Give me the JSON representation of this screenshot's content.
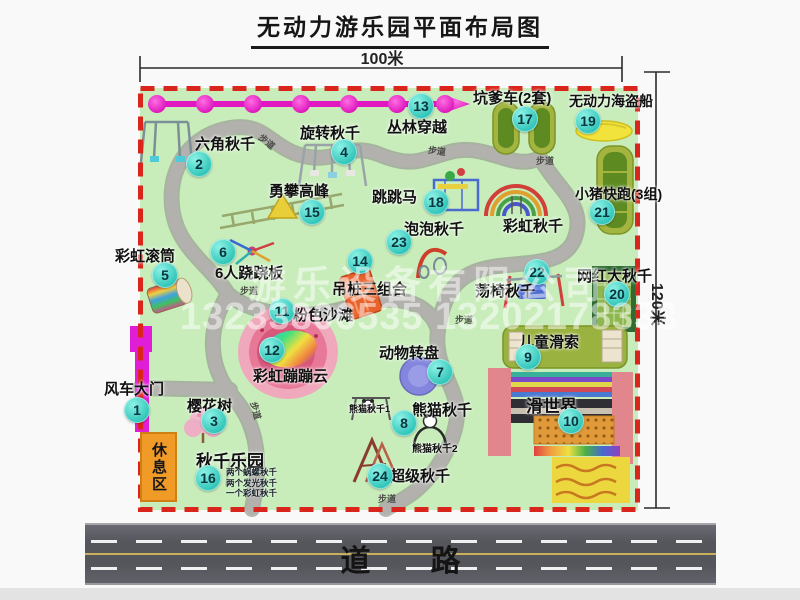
{
  "title": "无动力游乐园平面布局图",
  "dimensions": {
    "width_label": "100米",
    "height_label": "120米"
  },
  "watermark": {
    "company": "游乐设备有限公司",
    "phones": "13233806535 13202178333"
  },
  "road": {
    "label": "道　　路"
  },
  "rest_area_label": "休息区",
  "path_label": "步道",
  "extra_labels": {
    "rainbow_swing": "彩虹秋千",
    "panda_swing_1": "熊猫秋千1",
    "panda_swing_2": "熊猫秋千2"
  },
  "items": [
    {
      "num": "1",
      "label": "风车大门"
    },
    {
      "num": "2",
      "label": "六角秋千"
    },
    {
      "num": "3",
      "label": "樱花树"
    },
    {
      "num": "4",
      "label": "旋转秋千"
    },
    {
      "num": "5",
      "label": "彩虹滚筒"
    },
    {
      "num": "6",
      "label": "6人跷跷板"
    },
    {
      "num": "7",
      "label": "动物转盘"
    },
    {
      "num": "8",
      "label": "熊猫秋千"
    },
    {
      "num": "9",
      "label": "儿童滑索"
    },
    {
      "num": "10",
      "label": "滑世界"
    },
    {
      "num": "11",
      "label": "粉色沙滩"
    },
    {
      "num": "12",
      "label": "彩虹蹦蹦云"
    },
    {
      "num": "13",
      "label": "丛林穿越"
    },
    {
      "num": "14",
      "label": "吊桩三组合"
    },
    {
      "num": "15",
      "label": "勇攀高峰"
    },
    {
      "num": "16",
      "label": "秋千乐园"
    },
    {
      "num": "17",
      "label": "坑爹车(2套)"
    },
    {
      "num": "18",
      "label": "跳跳马"
    },
    {
      "num": "19",
      "label": "无动力海盗船"
    },
    {
      "num": "20",
      "label": "网红大秋千"
    },
    {
      "num": "21",
      "label": "小猪快跑(3组)"
    },
    {
      "num": "22",
      "label": "荡椅秋千"
    },
    {
      "num": "23",
      "label": "泡泡秋千"
    },
    {
      "num": "24",
      "label": "超级秋千"
    }
  ],
  "item16_sub": [
    "两个蜗螺秋千",
    "两个发光秋千",
    "一个彩虹秋千"
  ],
  "colors": {
    "map_green": "#c8edbb",
    "border_red": "#da251c",
    "marker_teal": "#2fc4b8",
    "chain_magenta": "#e018c2",
    "rest_orange": "#f09a28",
    "road_gray": "#5a5a61"
  }
}
